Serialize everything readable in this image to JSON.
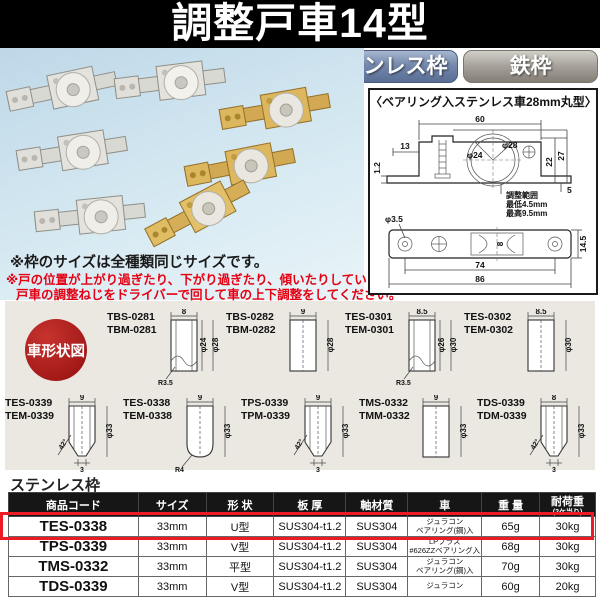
{
  "header": {
    "title": "調整戸車14型"
  },
  "tabs": {
    "stainless": "ステンレス枠",
    "iron": "鉄枠"
  },
  "notes": {
    "note1": "※枠のサイズは全種類同じサイズです。",
    "note2a": "※戸の位置が上がり過ぎたり、下がり過ぎたり、傾いたりしている場合は、",
    "note2b": "戸車の調整ねじをドライバーで回して車の上下調整をしてください。"
  },
  "drawing": {
    "title": "〈ベアリング入ステンレス車28mm丸型〉",
    "side": {
      "w60": "60",
      "w13": "13",
      "t12": "1.2",
      "d24": "φ24",
      "d28": "φ28",
      "h22": "22",
      "h27": "27",
      "h5": "5",
      "adj1": "調整範囲",
      "adj2": "最低4.5mm",
      "adj3": "最高9.5mm"
    },
    "bottom": {
      "d35": "φ3.5",
      "s8": "8",
      "l74": "74",
      "l86": "86",
      "h145": "14.5"
    }
  },
  "shapes": {
    "label": "車形状図",
    "row1": [
      {
        "code1": "TBS-0281",
        "code2": "TBM-0281",
        "top": "8",
        "dia1": "φ24",
        "dia2": "φ28",
        "extra": "R3.5"
      },
      {
        "code1": "TBS-0282",
        "code2": "TBM-0282",
        "top": "9",
        "dia2": "φ28"
      },
      {
        "code1": "TES-0301",
        "code2": "TEM-0301",
        "top": "8.5",
        "dia1": "φ26",
        "dia2": "φ30",
        "extra": "R3.5"
      },
      {
        "code1": "TES-0302",
        "code2": "TEM-0302",
        "top": "8.5",
        "dia2": "φ30"
      }
    ],
    "row2": [
      {
        "code1": "TES-0339",
        "code2": "TEM-0339",
        "top": "9",
        "dia2": "φ33",
        "angle": "42°",
        "bottom": "3"
      },
      {
        "code1": "TES-0338",
        "code2": "TEM-0338",
        "top": "9",
        "dia2": "φ33",
        "extra": "R4"
      },
      {
        "code1": "TPS-0339",
        "code2": "TPM-0339",
        "top": "9",
        "dia2": "φ33",
        "angle": "42°",
        "bottom": "3"
      },
      {
        "code1": "TMS-0332",
        "code2": "TMM-0332",
        "top": "9",
        "dia2": "φ33"
      },
      {
        "code1": "TDS-0339",
        "code2": "TDM-0339",
        "top": "8",
        "dia2": "φ33",
        "angle": "42°",
        "bottom": "3"
      }
    ]
  },
  "table": {
    "label": "ステンレス枠",
    "headers": [
      "商品コード",
      "サイズ",
      "形 状",
      "板 厚",
      "軸材質",
      "車",
      "重 量",
      "耐荷重"
    ],
    "load_note": "(2ケ当り)",
    "rows": [
      {
        "code": "TES-0338",
        "size": "33mm",
        "shape": "U型",
        "plate": "SUS304-t1.2",
        "shaft": "SUS304",
        "wheel1": "ジュラコン",
        "wheel2": "ベアリング(鋼)入",
        "weight": "65g",
        "load": "30kg"
      },
      {
        "code": "TPS-0339",
        "size": "33mm",
        "shape": "V型",
        "plate": "SUS304-t1.2",
        "shaft": "SUS304",
        "wheel1": "LPブラス",
        "wheel2": "#626ZZベアリング入",
        "weight": "68g",
        "load": "30kg"
      },
      {
        "code": "TMS-0332",
        "size": "33mm",
        "shape": "平型",
        "plate": "SUS304-t1.2",
        "shaft": "SUS304",
        "wheel1": "ジュラコン",
        "wheel2": "ベアリング(鋼)入",
        "weight": "70g",
        "load": "30kg"
      },
      {
        "code": "TDS-0339",
        "size": "33mm",
        "shape": "V型",
        "plate": "SUS304-t1.2",
        "shaft": "SUS304",
        "wheel1": "ジュラコン",
        "wheel2": "",
        "weight": "60g",
        "load": "20kg"
      }
    ]
  },
  "colors": {
    "header_bg": "#000000",
    "badge_stainless": "#6e86ad",
    "badge_iron": "#9b968f",
    "note_red": "#e60012",
    "shape_circle_red": "#a31a18",
    "highlight_red": "#ed1c24",
    "table_header_bg": "#161616",
    "photo_bg": "#cfe3ef",
    "shapes_bg": "#ebe8e2"
  }
}
